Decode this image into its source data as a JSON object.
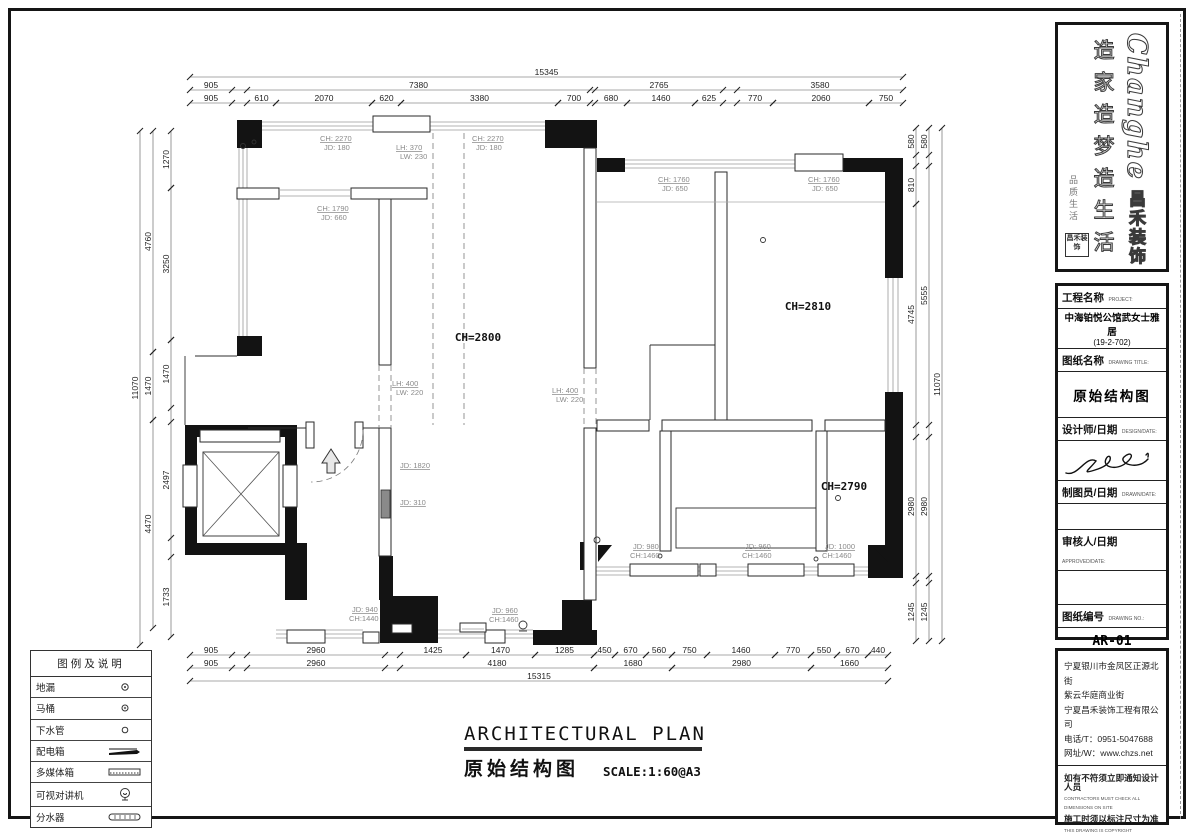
{
  "logo": {
    "brand": "Changhe",
    "brand_cn": "昌禾装饰",
    "slogans": "造家造梦造生活",
    "tagline": "品质生活",
    "seal": "昌禾装饰"
  },
  "titleblock": {
    "project_label": "工程名称",
    "project_label_en": "PROJECT:",
    "project_value": "中海铂悦公馆武女士雅居",
    "project_unit": "(19-2-702)",
    "drawing_label": "图纸名称",
    "drawing_label_en": "DRAWING TITLE:",
    "drawing_value": "原始结构图",
    "designer_label": "设计师/日期",
    "designer_label_en": "DESIGN/DATE:",
    "drafter_label": "制图员/日期",
    "drafter_label_en": "DRAWN/DATE:",
    "approver_label": "审核人/日期",
    "approver_label_en": "APPROVED/DATE:",
    "number_label": "图纸编号",
    "number_label_en": "DRAWING NO.:",
    "number_value": "AR-01",
    "scale_label": "比例",
    "scale_label_en": "SCALE:",
    "scale_value": "1：50"
  },
  "company": {
    "address1": "宁夏银川市金凤区正源北街",
    "address2": "紫云华庭商业街",
    "name": "宁夏昌禾装饰工程有限公司",
    "phone": "电话/T：0951-5047688",
    "web": "网址/W：www.chzs.net",
    "note1": "如有不符须立即通知设计人员",
    "note1_en": "CONTRACTORS MUST CHECK ALL DIMENSIONS ON SITE",
    "note2": "施工时须以标注尺寸为准",
    "note2_en": "THIS DRAWING IS COPYRIGHT"
  },
  "legend": {
    "title": "图例及说明",
    "items": [
      {
        "name": "地漏"
      },
      {
        "name": "马桶"
      },
      {
        "name": "下水管"
      },
      {
        "name": "配电箱"
      },
      {
        "name": "多媒体箱"
      },
      {
        "name": "可视对讲机"
      },
      {
        "name": "分水器"
      }
    ]
  },
  "footer": {
    "title_en": "ARCHITECTURAL PLAN",
    "title_cn": "原始结构图",
    "scale_note": "SCALE:1:60@A3"
  },
  "rooms": [
    {
      "label": "CH=2800"
    },
    {
      "label": "CH=2810"
    },
    {
      "label": "CH=2790"
    }
  ],
  "annotations": [
    {
      "l1": "CH: 2270",
      "l2": "JD: 180"
    },
    {
      "l1": "CH: 2270",
      "l2": "JD: 180"
    },
    {
      "l1": "LH: 370",
      "l2": "LW: 230"
    },
    {
      "l1": "CH: 1790",
      "l2": "JD: 660"
    },
    {
      "l1": "CH: 1760",
      "l2": "JD: 650"
    },
    {
      "l1": "CH: 1760",
      "l2": "JD: 650"
    },
    {
      "l1": "LH: 400",
      "l2": "LW: 220"
    },
    {
      "l1": "LH: 400",
      "l2": "LW: 220"
    },
    {
      "l1": "JD: 1820",
      "l2": ""
    },
    {
      "l1": "JD: 310",
      "l2": ""
    },
    {
      "l1": "JD: 980",
      "l2": "CH:1460"
    },
    {
      "l1": "JD: 960",
      "l2": "CH:1460"
    },
    {
      "l1": "JD: 1000",
      "l2": "CH:1460"
    },
    {
      "l1": "JD: 940",
      "l2": "CH:1440"
    },
    {
      "l1": "JD: 960",
      "l2": "CH:1460"
    }
  ],
  "dims": {
    "top_total": [
      "15345"
    ],
    "top1": [
      "905",
      "7380",
      "2765",
      "3580"
    ],
    "top2": [
      "905",
      "610",
      "2070",
      "620",
      "3380",
      "700",
      "680",
      "1460",
      "625",
      "770",
      "2060",
      "750"
    ],
    "bottom1": [
      "905",
      "2960",
      "1425",
      "1470",
      "1285",
      "450",
      "670",
      "560",
      "750",
      "1460",
      "770",
      "550",
      "670",
      "440"
    ],
    "bottom2": [
      "905",
      "2960",
      "4180",
      "1680",
      "2980",
      "1660"
    ],
    "bottom_total": [
      "15315"
    ],
    "left_total": [
      "11070"
    ],
    "left1": [
      "4760",
      "1470",
      "4470"
    ],
    "left2": [
      "1270",
      "3250",
      "1470",
      "2497",
      "1733"
    ],
    "right1": [
      "580",
      "810",
      "4745",
      "2980",
      "1245"
    ],
    "right2": [
      "580",
      "5555",
      "2980",
      "1245"
    ],
    "right_total": [
      "11070"
    ]
  }
}
